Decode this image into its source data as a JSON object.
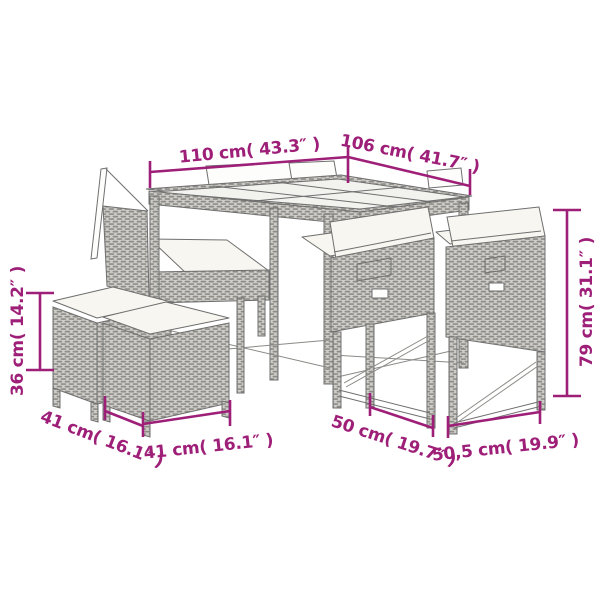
{
  "colors": {
    "annotation": "#9e1f78"
  },
  "annotations": {
    "table_length": "110 cm( 43.3″ )",
    "table_depth": "106 cm( 41.7″ )",
    "chair_height": "79 cm( 31.1″ )",
    "stool_height": "36 cm( 14.2″ )",
    "stool_depth": "41 cm( 16.1″ )",
    "stool_width": "41 cm( 16.1″ )",
    "chair_depth": "50 cm( 19.7″ )",
    "chair_width": "50,5 cm( 19.9″ )"
  }
}
